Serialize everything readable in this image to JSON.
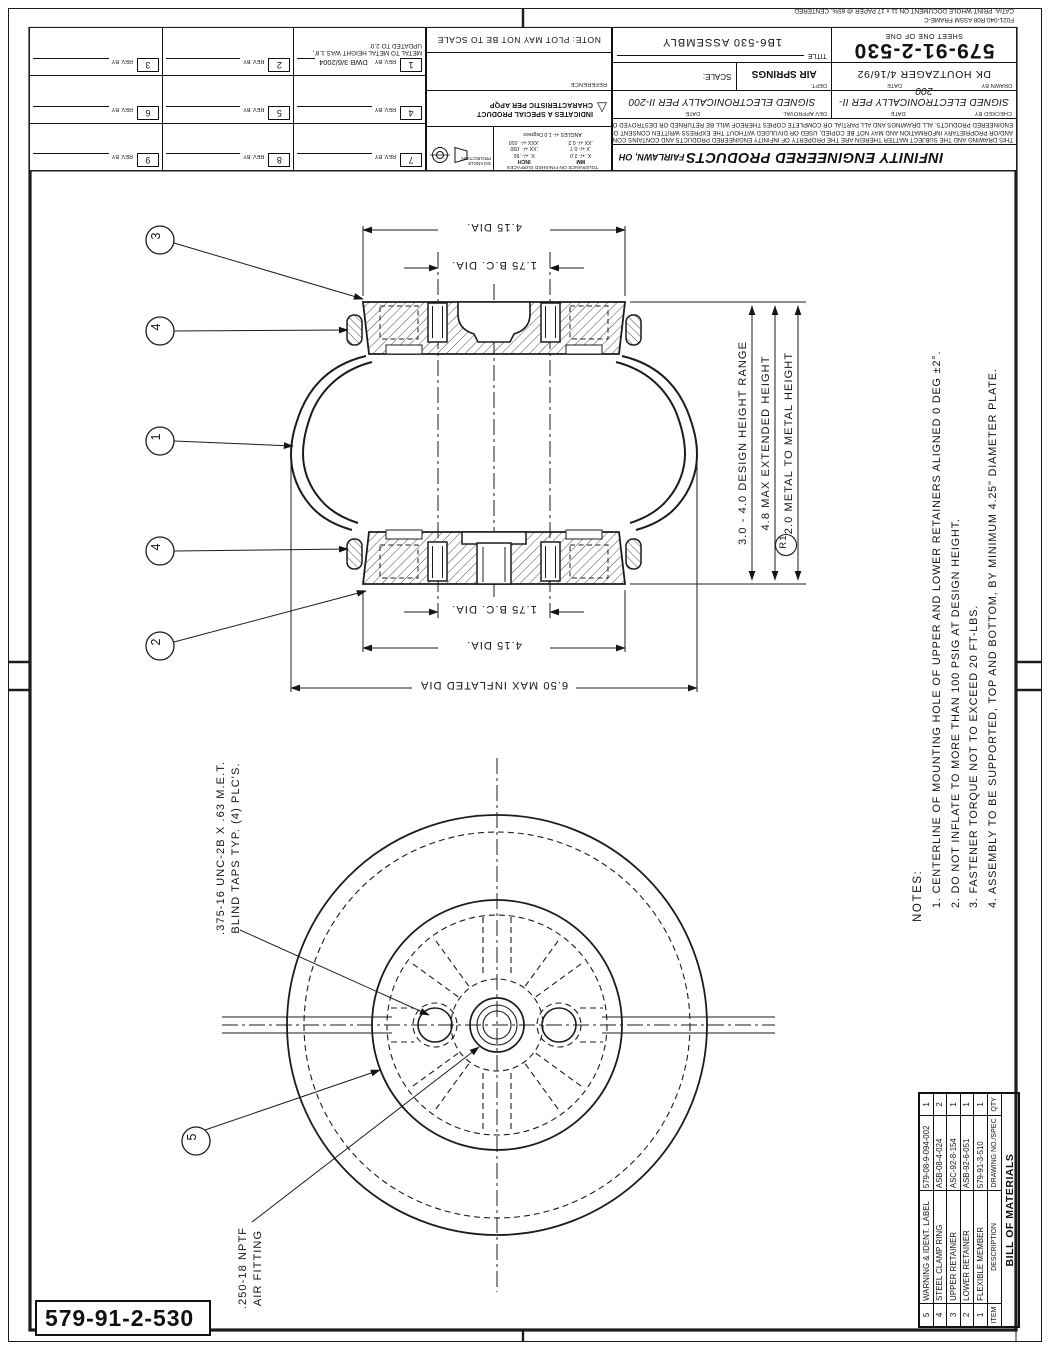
{
  "frame_note": [
    "F021-040.R08   ASSM FRAME-C",
    "CATIA: PRINT WHOLE DOCUMENT ON 11 x 17 PAPER @ 65%, CENTERED"
  ],
  "title_block": {
    "company": "INFINITY ENGINEERED PRODUCTS",
    "location": "FAIRLAWN, OH",
    "conf": [
      "THIS DRAWING AND THE SUBJECT MATTER THEREIN ARE THE PROPERTY OF INFINITY ENGINEERED PRODUCTS AND CONTAINS CONFIDENTIAL",
      "AND/OR PROPRIETARY INFORMATION AND MAY NOT BE COPIED, USED OR DIVULGED WITHOUT THE EXPRESS WRITTEN CONSENT OF INFINITY",
      "ENGINEERED PRODUCTS.  ALL DRAWINGS AND ALL PARTIAL OR COMPLETE COPIES THEREOF WILL BE RETURNED OR DESTROYED ON REQUEST."
    ],
    "signed": "SIGNED ELECTRONICALLY PER II-200",
    "checked_label": "CHECKED BY",
    "dev_label": "DEV APPROVAL",
    "date_label": "DATE",
    "drawn_label": "DRAWN BY",
    "drawn_by": "DK HOUTZAGER 4/16/92",
    "dept_label": "DEPT.",
    "dept": "AIR SPRINGS",
    "scale_label": "SCALE:",
    "number": "579-91-2-530",
    "sheet": "SHEET ONE OF ONE",
    "title_label": "TITLE",
    "title": "1B6-530 ASSEMBLY"
  },
  "tolerance": {
    "header": "TOLERANCE ON FINISHED SURFACES",
    "mm": "MM",
    "inch": "INCH",
    "mm_rows": [
      "X.  +/- 2.0",
      ".X  +/- 0.7",
      ".XX  +/- 0.2"
    ],
    "inch_rows": [
      "X.  +/- .50",
      ".XX  +/- .030",
      ".XXX  +/- .010"
    ],
    "angles": "ANGLES +/- 1.0 Degrees",
    "projection": "3rd ANGLE PROJECTION"
  },
  "special": {
    "text": "INDICATES A SPECIAL PRODUCT CHARACTERISTIC PER APQP"
  },
  "reference": "REFERENCE",
  "plot_note": "NOTE:  PLOT MAY NOT BE TO SCALE",
  "revisions": {
    "nums": [
      "7",
      "8",
      "9",
      "4",
      "5",
      "6",
      "1",
      "2",
      "3"
    ],
    "rev_by": "REV. BY",
    "rev1_by": "DWB  3/6/2004",
    "rev1_note": "METAL TO METAL HEIGHT WAS 1.8', UPDATED TO 2.0'"
  },
  "drawing_number": "579-91-2-530",
  "notes": {
    "header": "NOTES:",
    "items": [
      "1. CENTERLINE OF MOUNTING HOLE OF UPPER AND LOWER RETAINERS ALIGNED 0 DEG ±2°.",
      "2. DO NOT INFLATE TO MORE THAN 100 PSIG AT DESIGN HEIGHT.",
      "3. FASTENER TORQUE NOT TO EXCEED 20 FT-LBS.",
      "4. ASSEMBLY TO BE SUPPORTED, TOP AND BOTTOM, BY MINIMUM 4.25\" DIAMETER PLATE."
    ]
  },
  "bom": {
    "title": "BILL OF MATERIALS",
    "headers": [
      "ITEM",
      "DESCRIPTION",
      "DRAWING NO./SPEC",
      "QTY"
    ],
    "rows": [
      [
        "5",
        "WARNING & IDENT. LABEL",
        "579-08-9-094-002",
        "1"
      ],
      [
        "4",
        "STEEL CLAMP RING",
        "ASB-08-4-024",
        "2"
      ],
      [
        "3",
        "UPPER RETAINER",
        "ASC-92-8-154",
        "1"
      ],
      [
        "2",
        "LOWER RETAINER",
        "ASB-92-6-051",
        "1"
      ],
      [
        "1",
        "FLEXIBLE MEMBER",
        "579-91-3-510",
        "1"
      ]
    ]
  },
  "dims": {
    "dia": "4.15  DIA.",
    "bc": "1.75  B.C. DIA.",
    "inflated": "6.50 MAX INFLATED DIA",
    "design": "3.0 - 4.0 DESIGN HEIGHT RANGE",
    "extended": "4.8 MAX EXTENDED HEIGHT",
    "metal": "2.0 METAL TO METAL HEIGHT",
    "rev_flag": "R1"
  },
  "callouts": {
    "tap1": ".375-16 UNC-2B X  .63 M.E.T.",
    "tap2": "BLIND TAPS TYP. (4) PLC'S.",
    "fit1": ".250-18 NPTF",
    "fit2": "AIR FITTING"
  },
  "balloons": [
    "3",
    "4",
    "1",
    "4",
    "2",
    "5"
  ]
}
